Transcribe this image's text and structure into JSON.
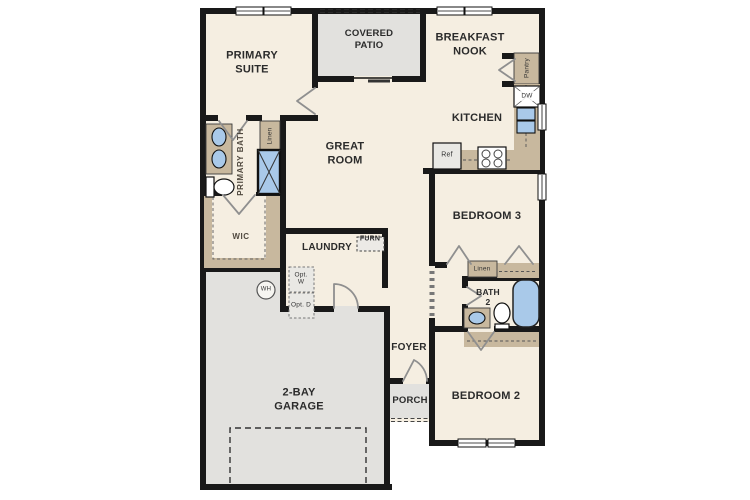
{
  "colors": {
    "floor": "#f5eee1",
    "outdoor": "#e2e1de",
    "wall": "#191919",
    "casework": "#c8b89e",
    "fixture": "#a9c9e9",
    "line": "#8f8f8f"
  },
  "rooms": {
    "primary_suite": "PRIMARY SUITE",
    "covered_patio": "COVERED PATIO",
    "breakfast_nook": "BREAKFAST NOOK",
    "kitchen": "KITCHEN",
    "great_room": "GREAT ROOM",
    "primary_bath": "PRIMARY BATH",
    "wic": "WIC",
    "laundry": "LAUNDRY",
    "garage": "2-BAY GARAGE",
    "foyer": "FOYER",
    "porch": "PORCH",
    "bedroom3": "BEDROOM 3",
    "bath2": "BATH 2",
    "bedroom2": "BEDROOM 2"
  },
  "fixtures": {
    "pantry": "Pantry",
    "dishwasher": "DW",
    "refrigerator": "Ref",
    "linen_primary": "Linen",
    "linen_hall": "Linen",
    "furnace": "FURN",
    "opt_washer": "Opt. W",
    "opt_dryer": "Opt. D",
    "water_heater": "WH"
  }
}
